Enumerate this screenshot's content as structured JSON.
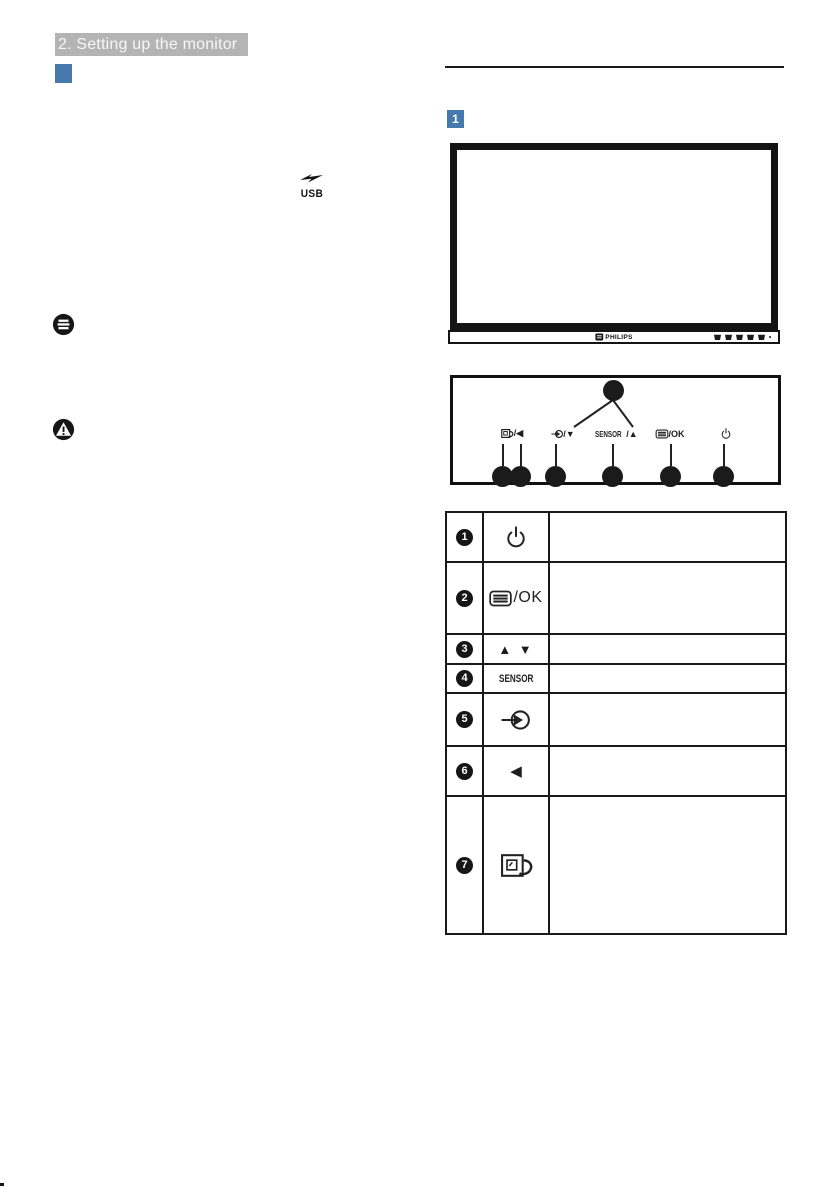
{
  "page": {
    "header_title": "2. Setting up the monitor"
  },
  "colors": {
    "accent_blue": "#4679ad",
    "header_gray": "#b4b4b4",
    "ink": "#1a1a1a"
  },
  "left_column": {
    "usb_icon_label": "USB"
  },
  "figure": {
    "marker": "1"
  },
  "monitor": {
    "brand_label": "PHILIPS"
  },
  "control_panel": {
    "smartimage_suffix": "/◀",
    "input_suffix": " /▼",
    "sensor_text": "SENSOR",
    "sensor_suffix": "/▲",
    "menu_suffix": "/OK",
    "icons": [
      "smartimage-icon",
      "input-source-icon",
      "sensor-label",
      "menu-ok-icon",
      "power-icon"
    ]
  },
  "table": {
    "rows": [
      {
        "num": "1",
        "icon": "power-icon",
        "description": ""
      },
      {
        "num": "2",
        "icon": "menu-ok-icon",
        "label": "/OK",
        "description": ""
      },
      {
        "num": "3",
        "icon": "up-down-arrows",
        "label": "▲ ▼",
        "description": ""
      },
      {
        "num": "4",
        "icon": "sensor-label",
        "label": "SENSOR",
        "description": ""
      },
      {
        "num": "5",
        "icon": "input-source-icon",
        "description": ""
      },
      {
        "num": "6",
        "icon": "back-arrow",
        "label": "◀",
        "description": ""
      },
      {
        "num": "7",
        "icon": "smartimage-icon",
        "description": ""
      }
    ]
  }
}
